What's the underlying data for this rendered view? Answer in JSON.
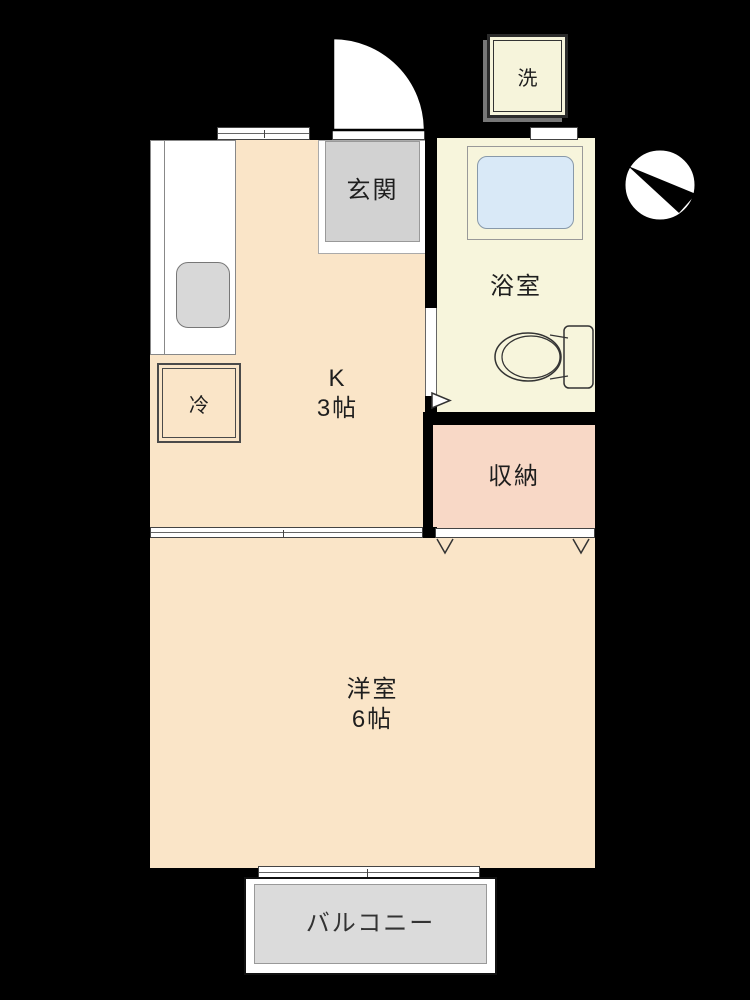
{
  "rooms": {
    "kitchen": {
      "label": "K",
      "size": "3帖"
    },
    "genkan": {
      "label": "玄関"
    },
    "bathroom": {
      "label": "浴室"
    },
    "storage": {
      "label": "収納"
    },
    "western": {
      "label": "洋室",
      "size": "6帖"
    },
    "balcony": {
      "label": "バルコニー"
    }
  },
  "fixtures": {
    "washer": "洗",
    "fridge": "冷"
  },
  "colors": {
    "background": "#000000",
    "wall": "#000000",
    "room_fill": "#FAE5C8",
    "storage_fill": "#F8D8C6",
    "bathroom_fill": "#F7F5DC",
    "bathtub_fill": "#D9E9F7",
    "genkan_fill": "#D2D2D2",
    "balcony_fill": "#DBDBDB",
    "sink_fill": "#D8D8D8"
  }
}
